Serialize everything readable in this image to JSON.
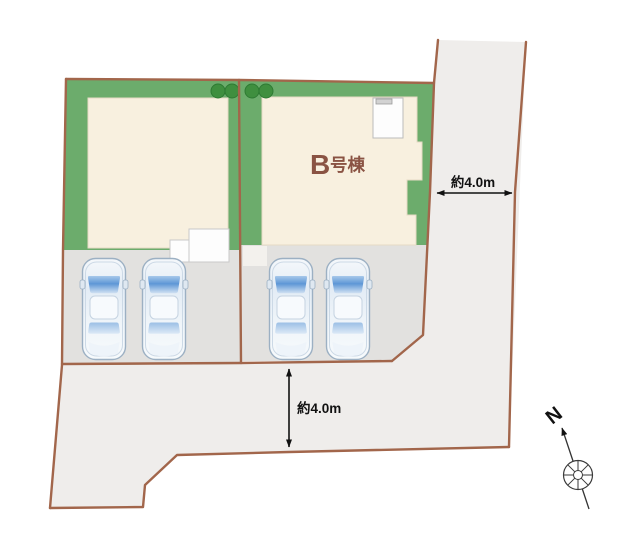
{
  "plan": {
    "building_b": {
      "label": "B号棟",
      "label_main": "B",
      "label_suffix": "号棟"
    },
    "annotations": {
      "right_road_width": "約4.0m",
      "bottom_road_width": "約4.0m"
    },
    "compass": {
      "north_label": "N"
    },
    "colors": {
      "boundary_line": "#a2664b",
      "lot_green": "#6cac6c",
      "tree_green": "#3f8f3f",
      "house_fill": "#f8f0df",
      "parking_fill": "#e2e1df",
      "road_fill": "#efedeb",
      "car_window_blue": "#5e97d6",
      "building_label_text": "#8a5343",
      "annotation_text": "#111111"
    }
  }
}
